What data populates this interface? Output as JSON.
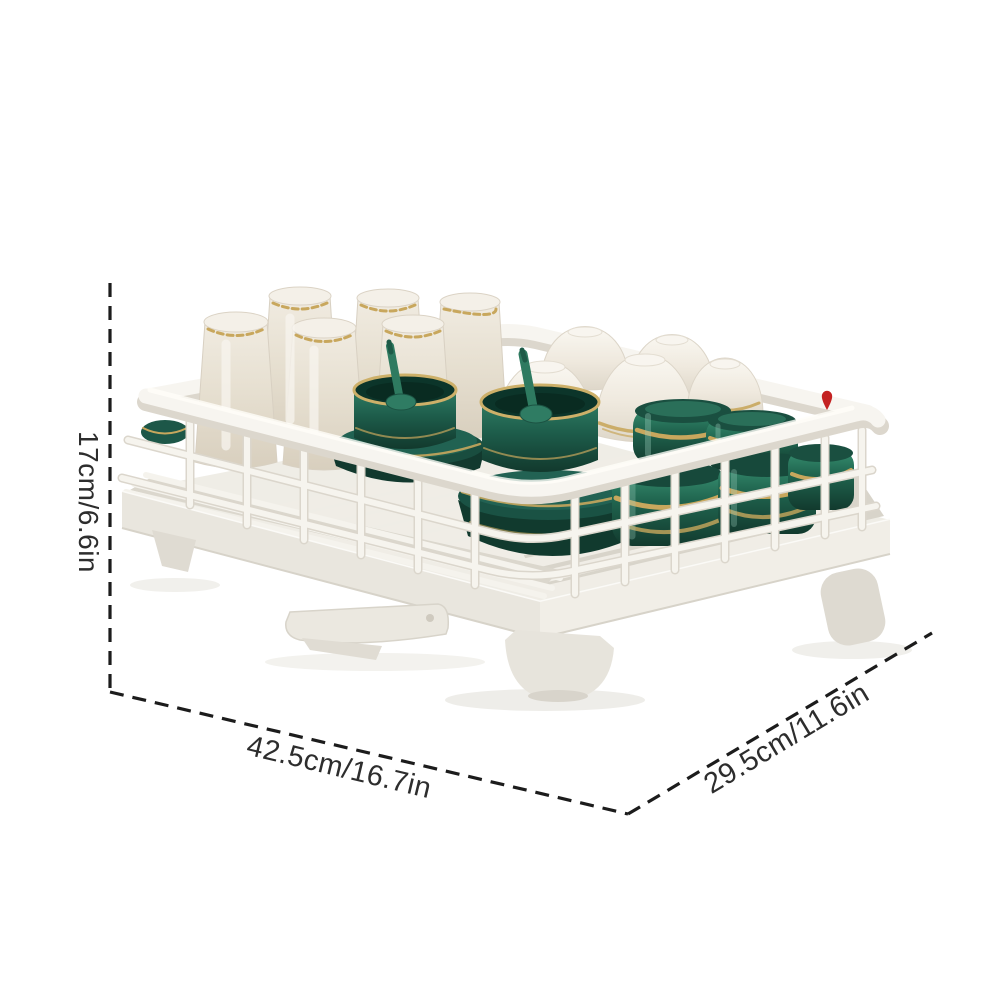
{
  "product_photo": {
    "description": "White wire dish drying rack on drainboard tray holding cream glasses, white bowls, dark green bowls with gold trim, green spoons and green jars"
  },
  "dimensions": {
    "height_label": "17cm/6.6in",
    "length_label": "42.5cm/16.7in",
    "width_label": "29.5cm/11.6in"
  },
  "icons": {
    "red_pin": "▾"
  },
  "colors": {
    "background": "#ffffff",
    "dimension_line": "#1c1c1c",
    "label_text": "#2d2d2d",
    "rack_white": "#f7f5f0",
    "rack_shadow": "#dcd7cd",
    "dish_green": "#1e5c4a",
    "dish_green_dark": "#113529",
    "gold_trim": "#c8a75d",
    "cream_glass": "#e9e2d4",
    "red_marker": "#c42222"
  }
}
